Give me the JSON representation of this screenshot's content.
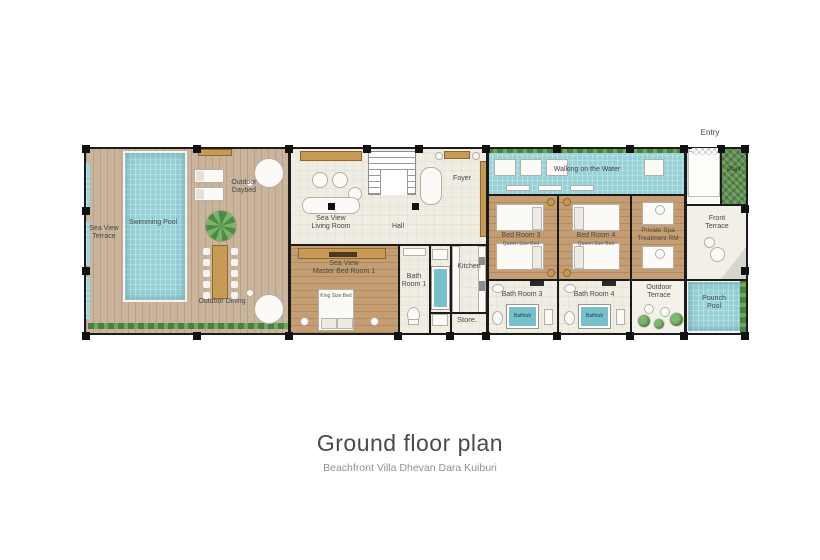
{
  "title": {
    "heading": "Ground floor plan",
    "subheading": "Beachfront Villa Dhevan Dara Kuiburi"
  },
  "rooms": {
    "sea_view_terrace": {
      "line1": "Sea View",
      "line2": "Terrace"
    },
    "swimming_pool": {
      "text": "Swimming Pool"
    },
    "outdoor_daybed": {
      "line1": "Outdoor",
      "line2": "Daybed"
    },
    "outdoor_dining": {
      "text": "Outdoor Dining"
    },
    "living_room": {
      "line1": "Sea View",
      "line2": "Living Room"
    },
    "hall": {
      "text": "Hall"
    },
    "foyer": {
      "text": "Foyer"
    },
    "master_bedroom": {
      "line1": "Sea View",
      "line2": "Master Bed Room 1"
    },
    "bath_room_1": {
      "line1": "Bath",
      "line2": "Room 1"
    },
    "kitchen": {
      "text": "Kitchen"
    },
    "store": {
      "text": "Store."
    },
    "walking_on_the_water": {
      "text": "Walking on the Water"
    },
    "bed_room_3": {
      "text": "Bed Room 3",
      "bed": "Queen Size Bed"
    },
    "bed_room_4": {
      "text": "Bed Room 4",
      "bed": "Queen Size Bed"
    },
    "bath_room_3": {
      "text": "Bath Room 3"
    },
    "bath_room_4": {
      "text": "Bath Room 4"
    },
    "private_spa": {
      "line1": "Private Spa",
      "line2": "Treatment RM"
    },
    "outdoor_terrace": {
      "line1": "Outdoor",
      "line2": "Terrace"
    },
    "front_terrace": {
      "line1": "Front",
      "line2": "Terrace"
    },
    "pounch_pool": {
      "line1": "Pounch",
      "line2": "Pool"
    },
    "entry": {
      "text": "Entry"
    },
    "plant": {
      "text": "Plant"
    }
  },
  "furniture_labels": {
    "king_bed": "King Size Bed",
    "bathtub": "Bathtub"
  },
  "colors": {
    "pool_water": "#97d2d8",
    "deck_wood": "#cab49c",
    "bedroom_wood": "#c59d73",
    "interior_floor": "#f0ede3",
    "wall": "#1b1b1b",
    "hedge_green": "#4c8042"
  }
}
